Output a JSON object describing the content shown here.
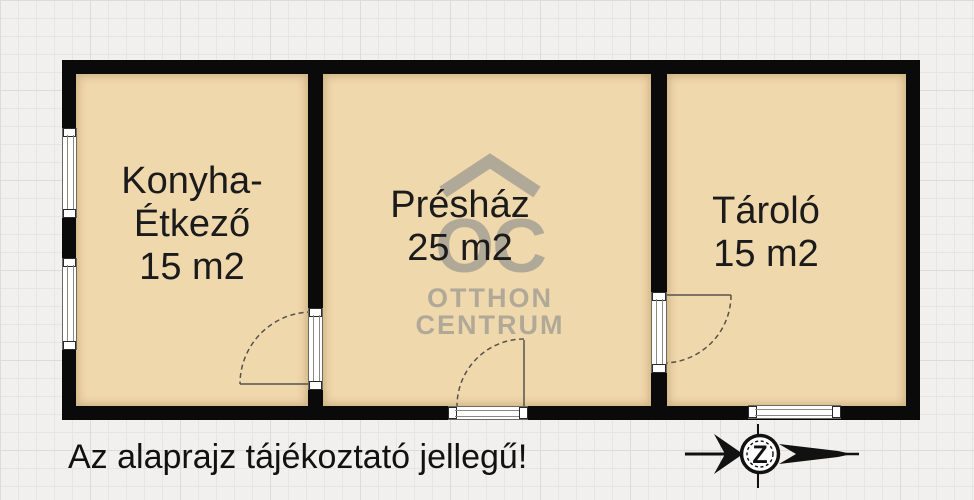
{
  "plan": {
    "rooms": [
      {
        "label_lines": [
          "Konyha-",
          "Étkező",
          "15 m2"
        ]
      },
      {
        "label_lines": [
          "Présház",
          "25 m2"
        ]
      },
      {
        "label_lines": [
          "Tároló",
          "15 m2"
        ]
      }
    ]
  },
  "watermark": {
    "monogram": "OC",
    "name_line1": "OTTHON",
    "name_line2": "CENTRUM"
  },
  "caption": "Az alaprajz tájékoztató jellegű!",
  "compass": {
    "letter": "Z"
  },
  "colors": {
    "wall": "#0a0a0a",
    "room_fill": "#f0d8ad",
    "watermark": "#a7a195",
    "background": "#f1f0ee",
    "grid_line": "#e6e5e1"
  }
}
